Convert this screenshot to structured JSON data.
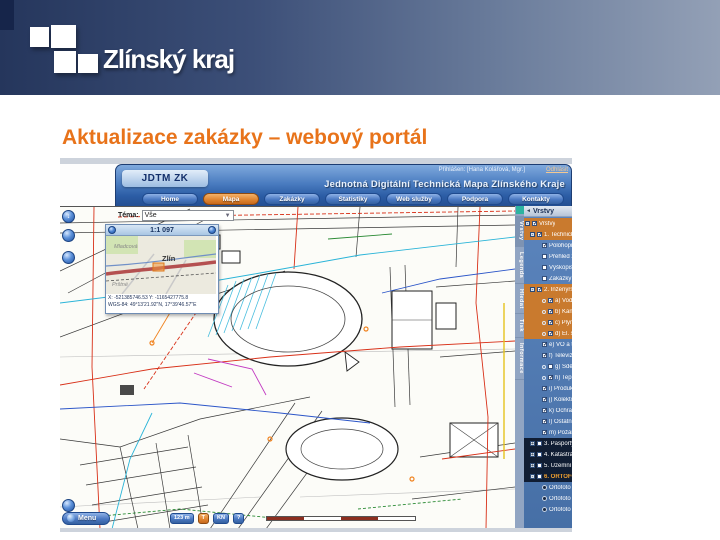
{
  "slide": {
    "logo_text": "Zlínský kraj",
    "title": "Aktualizace zakázky – webový portál"
  },
  "portal": {
    "brand": "JDTM ZK",
    "app_title": "Jednotná Digitální Technická Mapa Zlínského Kraje",
    "login_label": "Přihlášen: [Hana Kolářová, Mgr.]",
    "logout_label": "Odhlásit",
    "nav": [
      {
        "label": "Home",
        "active": false
      },
      {
        "label": "Mapa",
        "active": true
      },
      {
        "label": "Zakázky",
        "active": false
      },
      {
        "label": "Statistiky",
        "active": false
      },
      {
        "label": "Web služby",
        "active": false
      },
      {
        "label": "Podpora",
        "active": false
      },
      {
        "label": "Kontakty",
        "active": false
      }
    ],
    "map": {
      "theme_label": "Téma:",
      "theme_value": "Vše",
      "overview": {
        "scale": "1:1 097",
        "city_label": "Zlín",
        "district_top": "Mladcová",
        "district_bottom": "Prštné",
        "coords_line1": "X: -521385746.53 Y: -1165427775.8",
        "coords_line2": "WGS-84: 49°13'21.92\"N, 17°39'46.57\"E"
      },
      "bottom_bar": {
        "menu_label": "Menu",
        "buttons": [
          "123 m",
          "T",
          "KN",
          "?"
        ]
      }
    },
    "panel": {
      "tabs": [
        {
          "label": "Vrstvy",
          "active": true
        },
        {
          "label": "Legenda",
          "active": false
        },
        {
          "label": "Hledat",
          "active": false
        },
        {
          "label": "Tisk",
          "active": false
        },
        {
          "label": "Informace",
          "active": false
        }
      ],
      "header": "Vrstvy",
      "tree": [
        {
          "label": "Vrstvy",
          "indent": 0,
          "checked": true,
          "hl": true,
          "expand": "-"
        },
        {
          "label": "1. Technická mapa",
          "indent": 1,
          "checked": true,
          "hl": true,
          "expand": "-"
        },
        {
          "label": "Polohopis",
          "indent": 2,
          "checked": true
        },
        {
          "label": "Přehled zakázek",
          "indent": 2,
          "checked": false
        },
        {
          "label": "Výškopis",
          "indent": 2,
          "checked": false
        },
        {
          "label": "Zakázky v aktualizaci",
          "indent": 2,
          "checked": false
        },
        {
          "label": "2. Inženýrské sítě",
          "indent": 1,
          "checked": true,
          "hl": true,
          "expand": "-"
        },
        {
          "label": "a) Vodovody",
          "indent": 2,
          "checked": true,
          "hl": true,
          "node": true
        },
        {
          "label": "b) Kanalizace",
          "indent": 2,
          "checked": true,
          "hl": true,
          "node": true
        },
        {
          "label": "c) Plynovody",
          "indent": 2,
          "checked": true,
          "hl": true,
          "node": true
        },
        {
          "label": "d) El. silová vedení",
          "indent": 2,
          "checked": true,
          "hl": true,
          "node": true
        },
        {
          "label": "e) VO a tech. služby",
          "indent": 2,
          "checked": true
        },
        {
          "label": "f) Televizní kabely",
          "indent": 2,
          "checked": true
        },
        {
          "label": "g) Sdělovací vedení",
          "indent": 2,
          "checked": false,
          "node": true
        },
        {
          "label": "h) Teplovody",
          "indent": 2,
          "checked": true,
          "node": true
        },
        {
          "label": "i) Produktovody",
          "indent": 2,
          "checked": true
        },
        {
          "label": "j) Kolektory",
          "indent": 2,
          "checked": true
        },
        {
          "label": "k) Ochranná pásma",
          "indent": 2,
          "checked": true
        },
        {
          "label": "l) Ostatní vedení",
          "indent": 2,
          "checked": true
        },
        {
          "label": "m) Požární hydranty",
          "indent": 2,
          "checked": true
        },
        {
          "label": "3. Pasporty obcí",
          "indent": 1,
          "checked": false,
          "dark": true,
          "expand": "+"
        },
        {
          "label": "4. Katastrální mapa",
          "indent": 1,
          "checked": false,
          "dark": true,
          "expand": "+"
        },
        {
          "label": "5. Územní plány",
          "indent": 1,
          "checked": false,
          "dark": true,
          "expand": "+"
        },
        {
          "label": "6. ORTOFOTO",
          "indent": 1,
          "checked": false,
          "dark": true,
          "orange": true,
          "expand": "-"
        },
        {
          "label": "Ortofoto 2008 (WMS ZK)",
          "indent": 2,
          "radio": true
        },
        {
          "label": "Ortofoto 2012 (WMS)",
          "indent": 2,
          "radio": true
        },
        {
          "label": "Ortofoto 2014 (WMS ČÚZK)",
          "indent": 2,
          "radio": true
        }
      ]
    }
  }
}
